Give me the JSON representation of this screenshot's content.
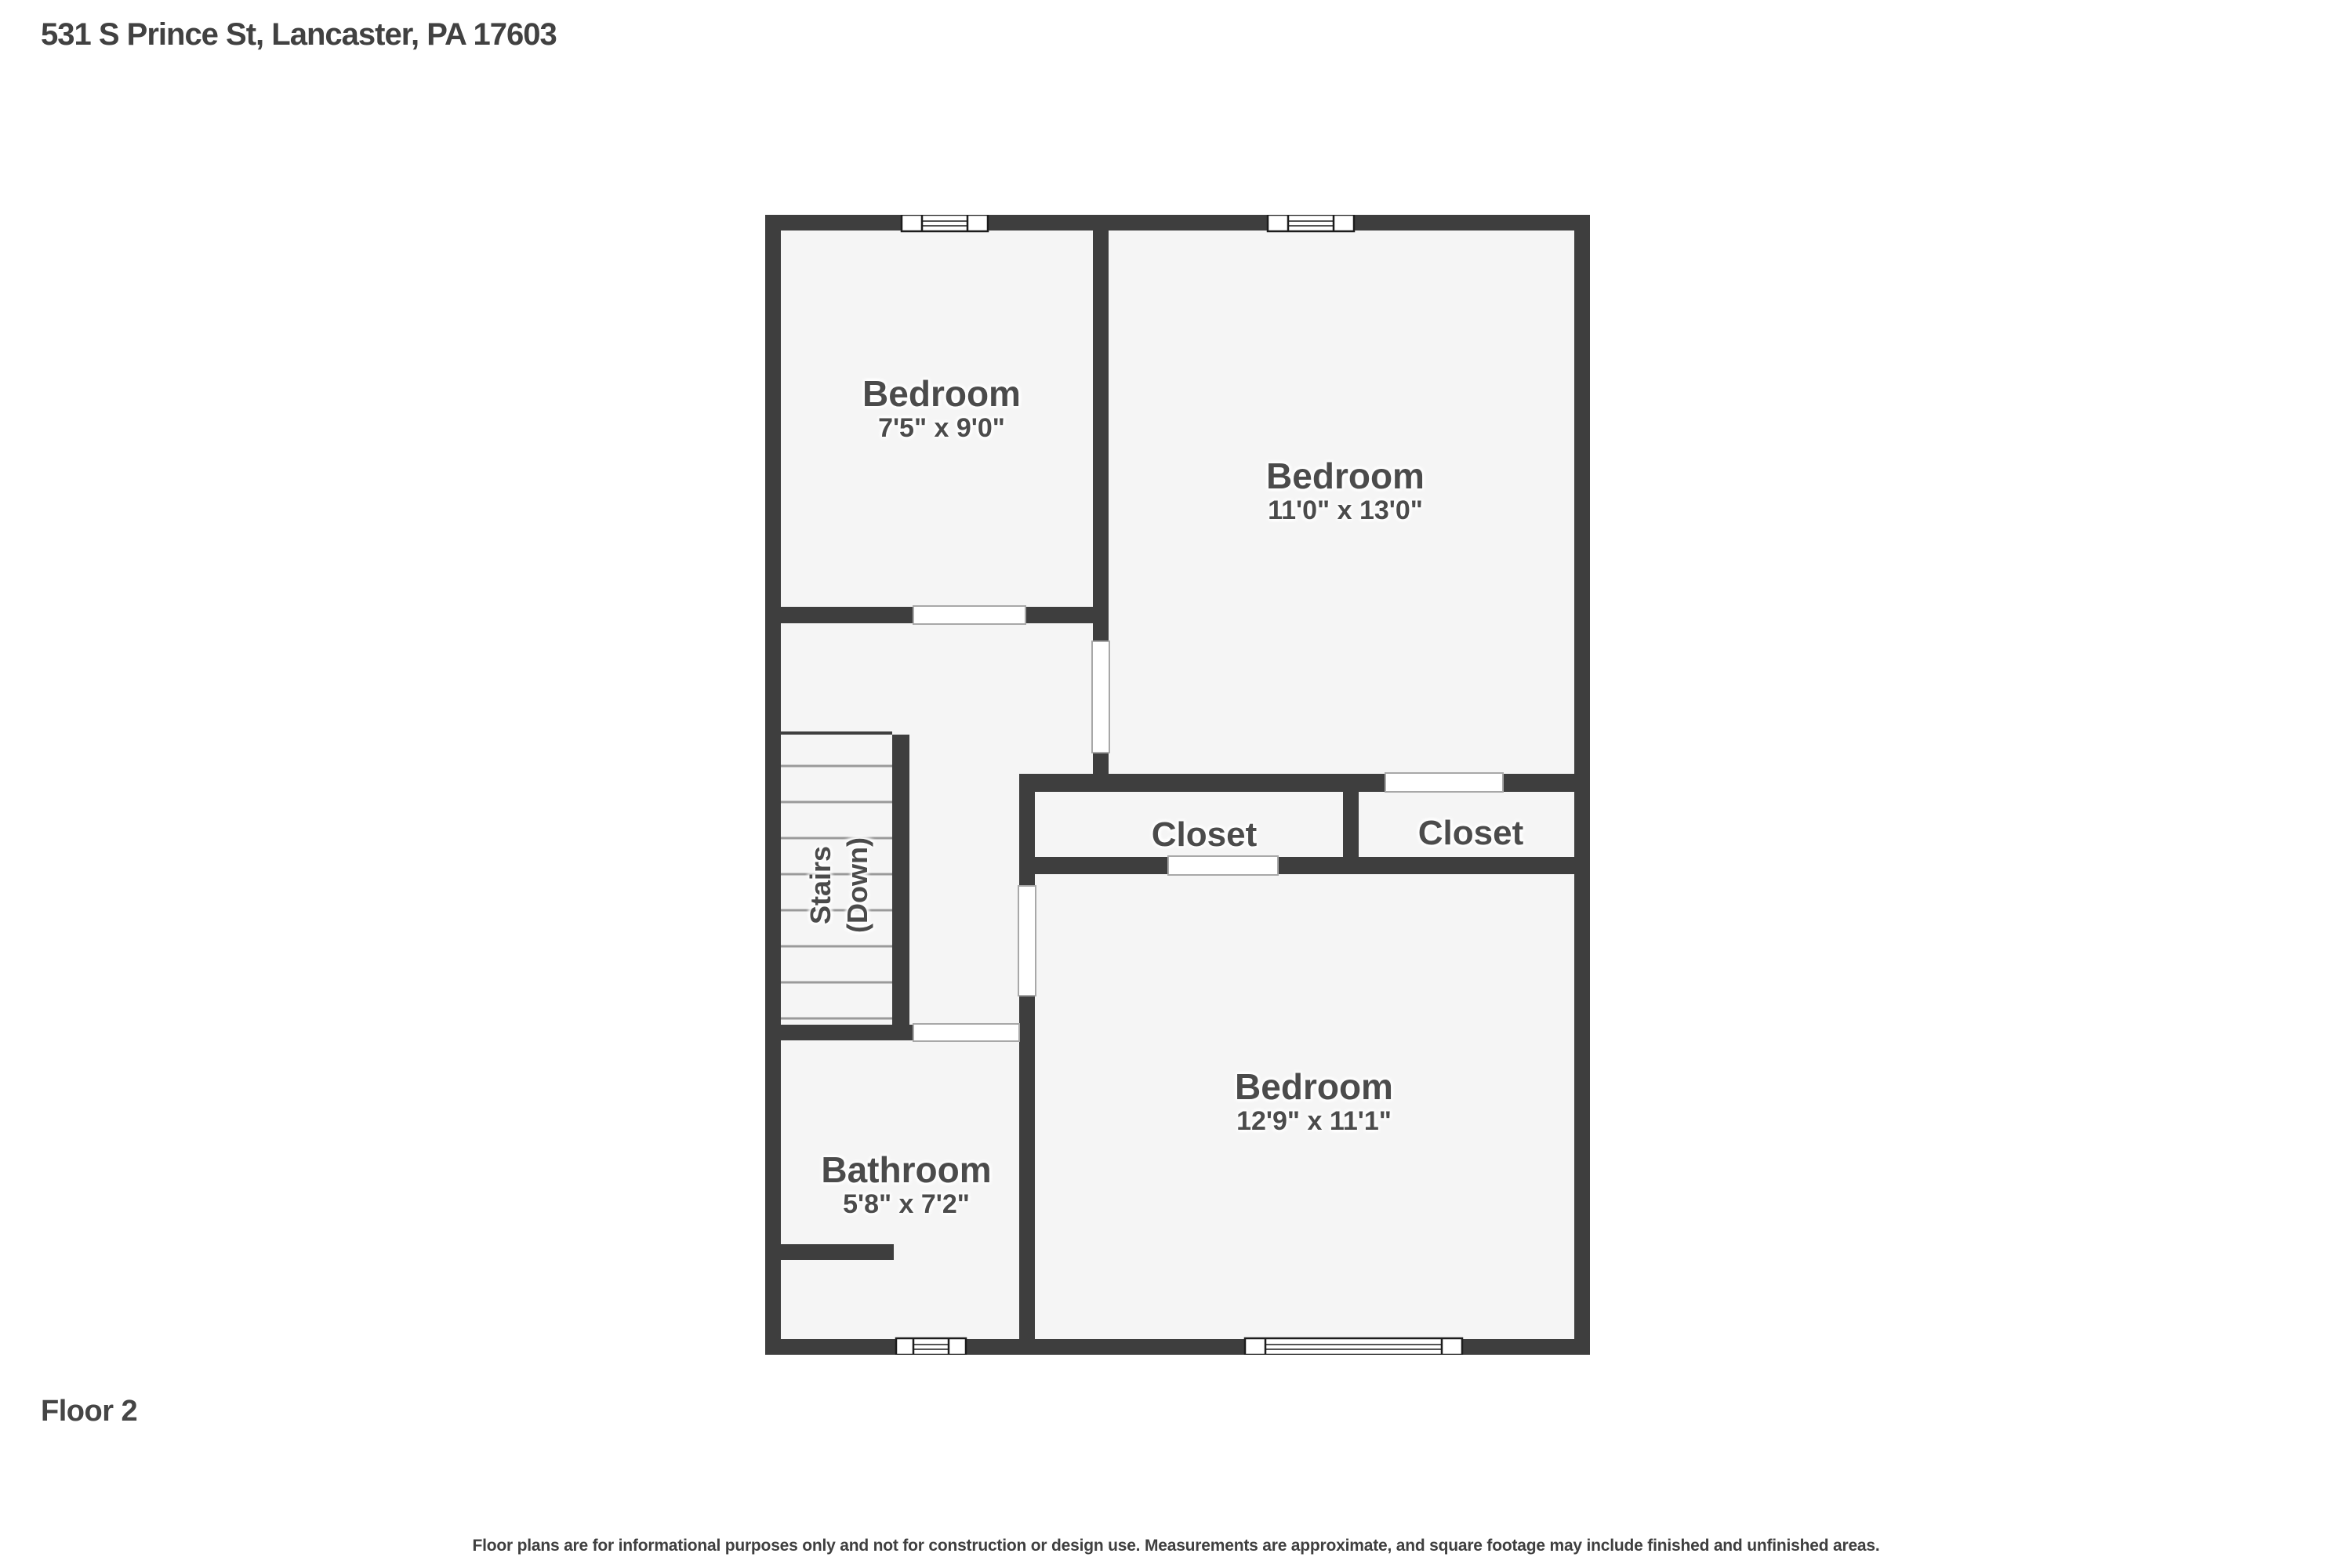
{
  "header": {
    "address": "531 S Prince St, Lancaster, PA 17603"
  },
  "floor_label": "Floor 2",
  "disclaimer": "Floor plans are for informational purposes only and not for construction or design use. Measurements are approximate, and square footage may include finished and unfinished areas.",
  "colors": {
    "wall": "#3e3e3e",
    "room_fill": "#f5f5f5",
    "label_text": "#4b4b4b",
    "opening_border": "#a8a8a8",
    "stair_tread": "#9a9a9a",
    "window_stroke": "#1c1c1c",
    "page_background": "#ffffff"
  },
  "rooms": [
    {
      "id": "bedroom-top-left",
      "name": "Bedroom",
      "dims": "7'5\" x 9'0\""
    },
    {
      "id": "bedroom-top-right",
      "name": "Bedroom",
      "dims": "11'0\" x 13'0\""
    },
    {
      "id": "closet-left",
      "name": "Closet",
      "dims": ""
    },
    {
      "id": "closet-right",
      "name": "Closet",
      "dims": ""
    },
    {
      "id": "bedroom-bottom",
      "name": "Bedroom",
      "dims": "12'9\" x 11'1\""
    },
    {
      "id": "bathroom",
      "name": "Bathroom",
      "dims": "5'8\" x 7'2\""
    },
    {
      "id": "stairs",
      "name": "Stairs",
      "dims": "(Down)"
    }
  ]
}
